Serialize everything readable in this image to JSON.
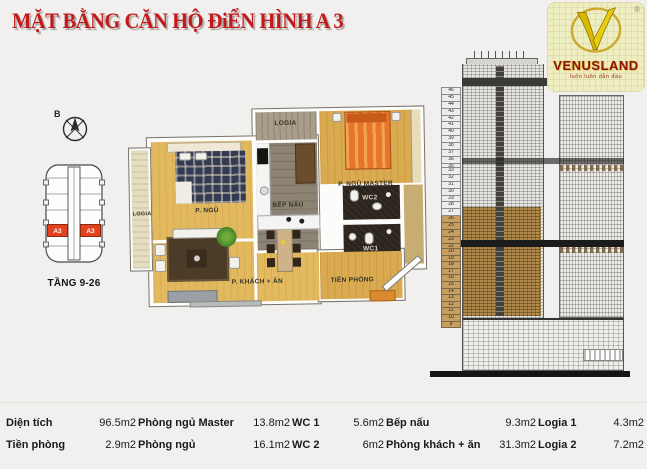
{
  "title": "MẶT BẰNG CĂN HỘ ĐiỂN HÌNH A 3",
  "logo": {
    "brand": "VENUSLAND",
    "tagline": "luôn luôn dẫn đầu",
    "registered": "®"
  },
  "key_plan": {
    "north_label": "B",
    "floor_label": "TẦNG 9-26",
    "unit_left": "A3",
    "unit_right": "A3"
  },
  "floor_plan": {
    "rooms": {
      "logia_top": "LOGIA",
      "logia_left": "LOGIA",
      "bedroom": "P. NGỦ",
      "master_bedroom": "P. NGỦ MASTER",
      "kitchen": "BẾP NẤU",
      "wc2": "WC2",
      "wc1": "WC1",
      "living_dining": "P. KHÁCH + ĂN",
      "entry": "TIỀN PHÒNG"
    }
  },
  "elevation": {
    "floors_upper": [
      "46",
      "45",
      "44",
      "43",
      "42",
      "41",
      "40",
      "39",
      "38",
      "37",
      "36",
      "35",
      "34"
    ],
    "floors_mid": [
      "33",
      "32",
      "31",
      "30",
      "29",
      "28",
      "27",
      "26",
      "25",
      "24",
      "23",
      "22",
      "21"
    ],
    "floors_lower": [
      "20",
      "19",
      "18",
      "17",
      "16",
      "15",
      "14",
      "13",
      "12",
      "11",
      "10",
      "9"
    ]
  },
  "area_table": {
    "rows": [
      [
        {
          "label": "Diện tích",
          "value": "96.5m2"
        },
        {
          "label": "Phòng ngủ Master",
          "value": "13.8m2"
        },
        {
          "label": "WC 1",
          "value": "5.6m2"
        },
        {
          "label": "Bếp nấu",
          "value": "9.3m2"
        },
        {
          "label": "Logia 1",
          "value": "4.3m2"
        }
      ],
      [
        {
          "label": "Tiền phòng",
          "value": "2.9m2"
        },
        {
          "label": "Phòng ngủ",
          "value": "16.1m2"
        },
        {
          "label": "WC 2",
          "value": "6m2"
        },
        {
          "label": "Phòng khách + ăn",
          "value": "31.3m2"
        },
        {
          "label": "Logia 2",
          "value": "7.2m2"
        }
      ]
    ]
  },
  "colors": {
    "title_red": "#c21a1c",
    "unit_highlight_red": "#e2421c",
    "floors_band_brown": "#b08a4c",
    "logo_yellow": "#eeeec1",
    "wood_floor_yellow": "#e2b95e",
    "background": "#f2f0ee"
  }
}
